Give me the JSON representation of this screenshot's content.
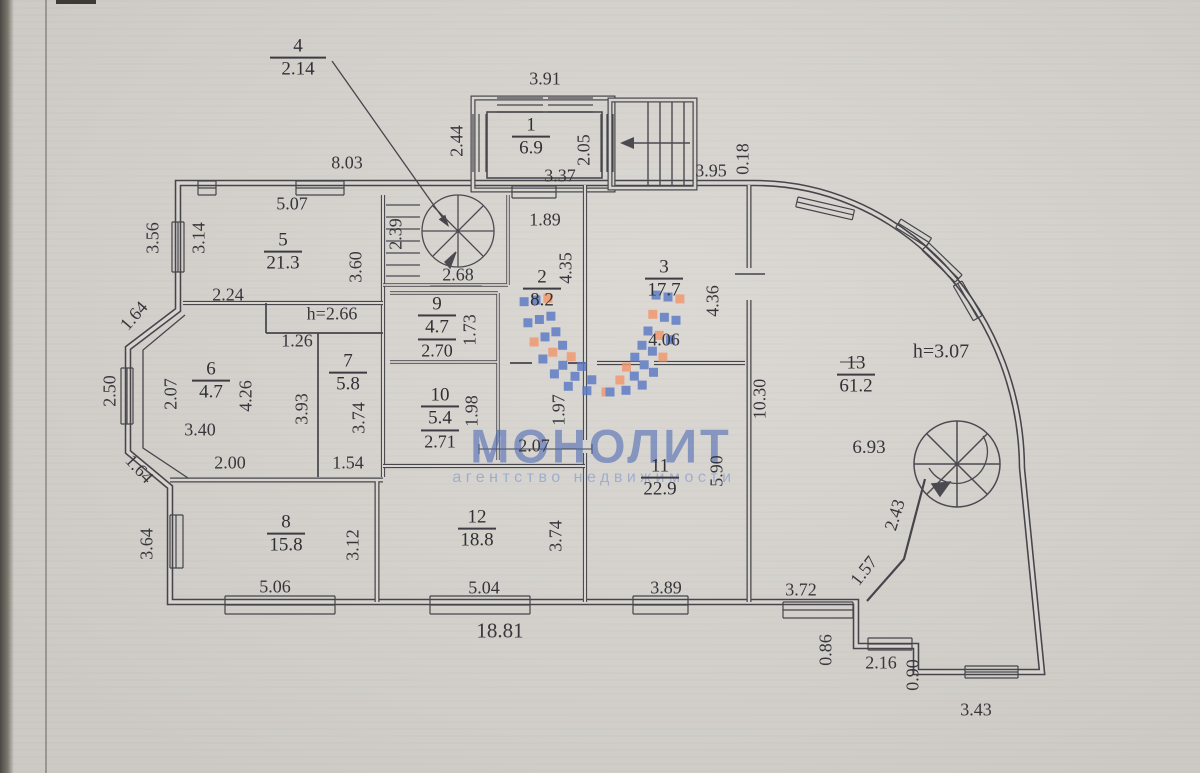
{
  "watermark": {
    "title": "МОНОЛИТ",
    "subtitle": "агентство недвижимости"
  },
  "colors": {
    "ink": "#45454b",
    "paper": "#d8d5d0",
    "logo_blue": "#5b79c4",
    "logo_orange": "#f0976c"
  },
  "annotation": {
    "num": "4",
    "value": "2.14"
  },
  "plan": {
    "rooms": [
      {
        "num": "1",
        "area": "6.9",
        "x": 531,
        "y": 137
      },
      {
        "num": "2",
        "area": "8.2",
        "x": 542,
        "y": 289
      },
      {
        "num": "3",
        "area": "17.7",
        "x": 664,
        "y": 279
      },
      {
        "num": "5",
        "area": "21.3",
        "x": 283,
        "y": 252
      },
      {
        "num": "6",
        "area": "4.7",
        "x": 211,
        "y": 381
      },
      {
        "num": "7",
        "area": "5.8",
        "x": 348,
        "y": 373
      },
      {
        "num": "8",
        "area": "15.8",
        "x": 286,
        "y": 534
      },
      {
        "num": "9",
        "area": "4.7",
        "h": "2.70",
        "x": 437,
        "y": 327
      },
      {
        "num": "10",
        "area": "5.4",
        "h": "2.71",
        "x": 440,
        "y": 418
      },
      {
        "num": "11",
        "area": "22.9",
        "x": 660,
        "y": 478
      },
      {
        "num": "12",
        "area": "18.8",
        "x": 477,
        "y": 529
      },
      {
        "num": "13",
        "area": "61.2",
        "x": 856,
        "y": 375
      }
    ],
    "dimensions": [
      {
        "t": "8.03",
        "x": 347,
        "y": 163
      },
      {
        "t": "5.07",
        "x": 292,
        "y": 204
      },
      {
        "t": "3.91",
        "x": 545,
        "y": 79
      },
      {
        "t": "2.44",
        "x": 457,
        "y": 141,
        "r": -90
      },
      {
        "t": "2.05",
        "x": 584,
        "y": 150,
        "r": -90
      },
      {
        "t": "3.37",
        "x": 560,
        "y": 176
      },
      {
        "t": "3.95",
        "x": 711,
        "y": 171
      },
      {
        "t": "0.18",
        "x": 743,
        "y": 159,
        "r": -90
      },
      {
        "t": "1.89",
        "x": 545,
        "y": 220
      },
      {
        "t": "2.39",
        "x": 396,
        "y": 234,
        "r": -90
      },
      {
        "t": "2.68",
        "x": 458,
        "y": 275
      },
      {
        "t": "4.35",
        "x": 566,
        "y": 268,
        "r": -90
      },
      {
        "t": "3.56",
        "x": 153,
        "y": 238,
        "r": -90
      },
      {
        "t": "3.14",
        "x": 199,
        "y": 238,
        "r": -90
      },
      {
        "t": "2.24",
        "x": 228,
        "y": 295
      },
      {
        "t": "3.60",
        "x": 356,
        "y": 267,
        "r": -90
      },
      {
        "t": "h=2.66",
        "x": 332,
        "y": 314
      },
      {
        "t": "1.26",
        "x": 297,
        "y": 341
      },
      {
        "t": "1.73",
        "x": 470,
        "y": 330,
        "r": -90
      },
      {
        "t": "2.50",
        "x": 110,
        "y": 391,
        "r": -90
      },
      {
        "t": "2.07",
        "x": 171,
        "y": 394,
        "r": -90
      },
      {
        "t": "4.26",
        "x": 246,
        "y": 396,
        "r": -90
      },
      {
        "t": "3.93",
        "x": 302,
        "y": 409,
        "r": -90
      },
      {
        "t": "3.40",
        "x": 200,
        "y": 430
      },
      {
        "t": "3.74",
        "x": 359,
        "y": 418,
        "r": -90
      },
      {
        "t": "1.98",
        "x": 472,
        "y": 411,
        "r": -90
      },
      {
        "t": "1.97",
        "x": 559,
        "y": 410,
        "r": -90
      },
      {
        "t": "2.07",
        "x": 534,
        "y": 446
      },
      {
        "t": "2.00",
        "x": 230,
        "y": 463
      },
      {
        "t": "1.54",
        "x": 348,
        "y": 463
      },
      {
        "t": "1.64",
        "x": 134,
        "y": 316,
        "r": -49
      },
      {
        "t": "1.64",
        "x": 139,
        "y": 469,
        "r": 47
      },
      {
        "t": "4.36",
        "x": 713,
        "y": 301,
        "r": -90
      },
      {
        "t": "4.06",
        "x": 664,
        "y": 340
      },
      {
        "t": "10.30",
        "x": 760,
        "y": 399,
        "r": -90
      },
      {
        "t": "5.90",
        "x": 717,
        "y": 471,
        "r": -90
      },
      {
        "t": "h=3.07",
        "x": 941,
        "y": 352,
        "s": 20
      },
      {
        "t": "6.93",
        "x": 869,
        "y": 448,
        "s": 19
      },
      {
        "t": "3.64",
        "x": 147,
        "y": 544,
        "r": -90
      },
      {
        "t": "3.12",
        "x": 353,
        "y": 545,
        "r": -90
      },
      {
        "t": "3.74",
        "x": 556,
        "y": 536,
        "r": -90
      },
      {
        "t": "5.06",
        "x": 275,
        "y": 587
      },
      {
        "t": "5.04",
        "x": 484,
        "y": 588
      },
      {
        "t": "3.89",
        "x": 666,
        "y": 588
      },
      {
        "t": "3.72",
        "x": 801,
        "y": 590
      },
      {
        "t": "18.81",
        "x": 500,
        "y": 631,
        "s": 21
      },
      {
        "t": "1.57",
        "x": 864,
        "y": 571,
        "r": -52
      },
      {
        "t": "2.43",
        "x": 895,
        "y": 515,
        "r": -73
      },
      {
        "t": "0.86",
        "x": 826,
        "y": 650,
        "r": -90
      },
      {
        "t": "2.16",
        "x": 881,
        "y": 663
      },
      {
        "t": "0.90",
        "x": 913,
        "y": 675,
        "r": -90
      },
      {
        "t": "3.43",
        "x": 976,
        "y": 710
      }
    ]
  }
}
